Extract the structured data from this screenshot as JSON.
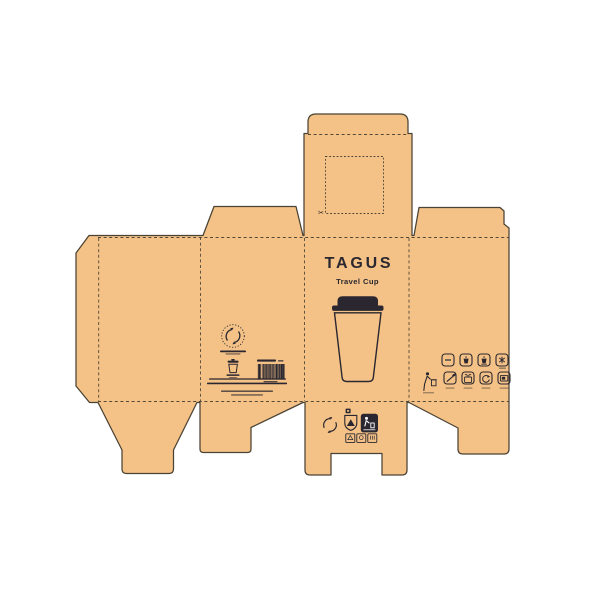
{
  "theme": {
    "background": "#ffffff",
    "kraft": "#f4c286",
    "line": "#4a4234",
    "ink": "#2a2730"
  },
  "front_panel": {
    "brand": "TAGUS",
    "product": "Travel Cup"
  },
  "top_flap": {
    "scissors_glyph": "✂"
  },
  "info_panel": {
    "logo": "recycle-loop-logo",
    "pictogram": "travel-cup-pictogram",
    "barcode": "ean-barcode",
    "microtext_line_count": 6
  },
  "usage_panel": {
    "row1_icons": [
      "dash",
      "hot-cup",
      "cold-cup",
      "snowflake"
    ],
    "row2_icons": [
      "tidyman",
      "pencil-leaf",
      "sprout-box",
      "recycle-arrow",
      "screen"
    ]
  },
  "bottom_flap_marks": [
    "recycle-arrows",
    "material-shield",
    "tidyman-badge",
    "code-square-1",
    "code-square-2",
    "code-square-3"
  ]
}
